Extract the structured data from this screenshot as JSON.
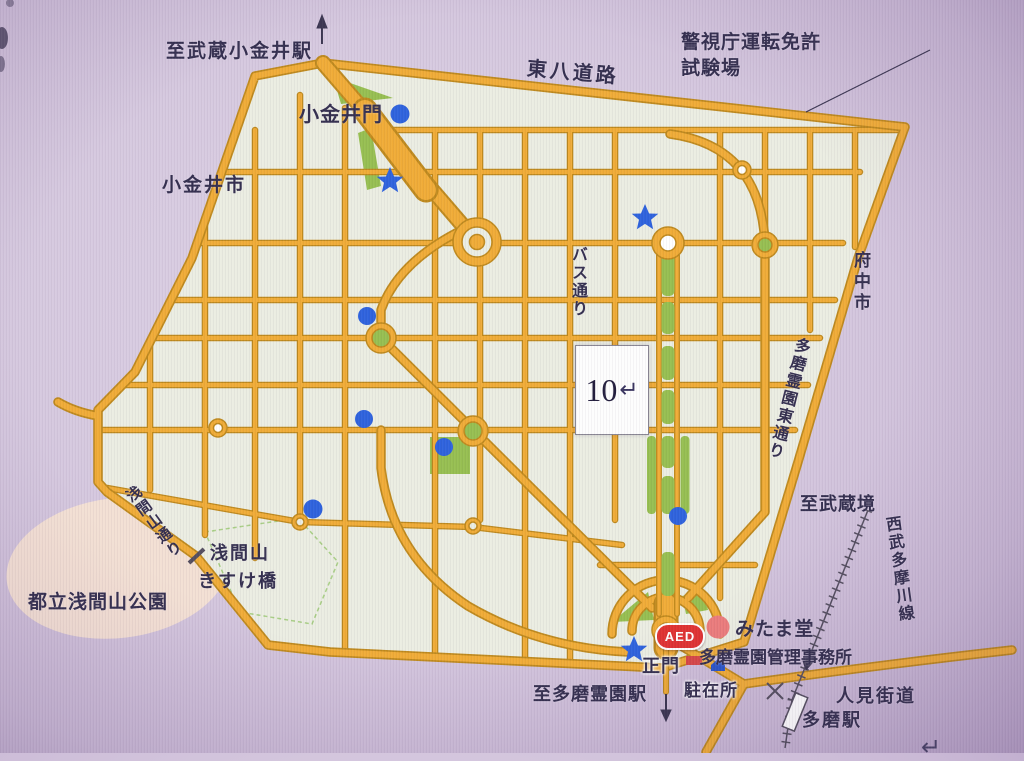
{
  "page": {
    "page_number": "10",
    "return_mark": "↵",
    "stray_return_mark": "↵"
  },
  "map": {
    "labels": {
      "to_musashi_koganei_station": "至武蔵小金井駅",
      "tohachi_road": "東八道路",
      "license_center_line1": "警視庁運転免許",
      "license_center_line2": "試験場",
      "koganei_gate": "小金井門",
      "koganei_city": "小金井市",
      "bus_street": "バス通り",
      "fuchu_city": "府中市",
      "tama_reien_east_street": "多磨霊園東通り",
      "to_musashisakai": "至武蔵境",
      "seibu_tamagawa_line": "西武多摩川線",
      "sengenyama_street": "浅間山通り",
      "sengenyama": "浅間山",
      "kisuke_bridge": "きすけ橋",
      "metropolitan_sengenyama_park": "都立浅間山公園",
      "mitama_hall": "みたま堂",
      "admin_office": "多磨霊園管理事務所",
      "main_gate": "正門",
      "police_box": "駐在所",
      "to_tama_reien_station": "至多磨霊園駅",
      "tama_station": "多磨駅",
      "hitomi_kaido": "人見街道",
      "aed_badge": "AED"
    },
    "colors": {
      "background": "#d7cbdf",
      "cemetery_fill": "#ebede2",
      "road_fill": "#f0ac38",
      "road_edge": "#bf8a1f",
      "green_area": "#97bf52",
      "park_pink": "#f6e2d3",
      "label_text": "#353050",
      "blue_marker": "#2f63dd",
      "red_badge": "#e03333",
      "mitama_red": "#ec7d7d",
      "office_red": "#d84848",
      "police_blue": "#2b56c8"
    },
    "markers": {
      "blue_dots": 6,
      "blue_stars": 3,
      "red_circles": 1
    }
  }
}
